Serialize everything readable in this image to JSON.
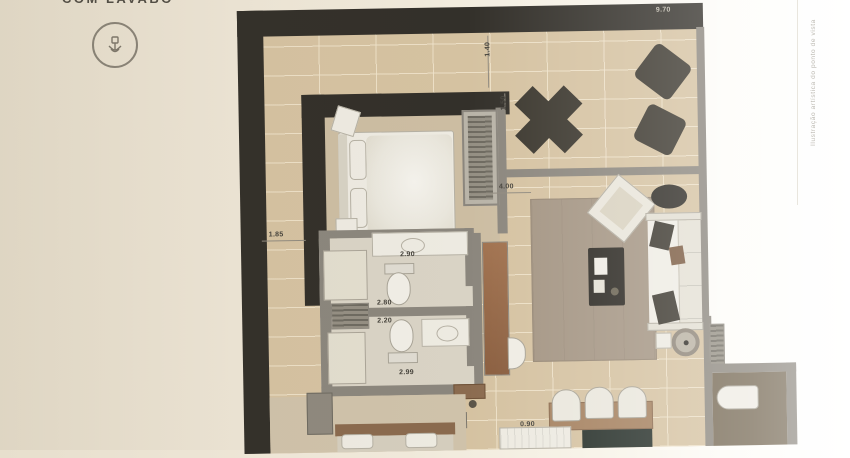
{
  "header": {
    "title_fragment": "COM LAVABO"
  },
  "branding": {
    "logo_icon": "flower-seal-icon"
  },
  "note_vertical": "Ilustração artística do ponto de vista",
  "plan": {
    "dimensions": [
      {
        "id": "total-width",
        "text": "9.70"
      },
      {
        "id": "dim-1-40",
        "text": "1.40"
      },
      {
        "id": "dim-1-50",
        "text": "1.50"
      },
      {
        "id": "dim-4-00",
        "text": "4.00"
      },
      {
        "id": "dim-1-85",
        "text": "1.85"
      },
      {
        "id": "dim-2-90",
        "text": "2.90"
      },
      {
        "id": "dim-2-80",
        "text": "2.80"
      },
      {
        "id": "dim-2-20",
        "text": "2.20"
      },
      {
        "id": "dim-2-99",
        "text": "2.99"
      },
      {
        "id": "dim-0-90",
        "text": "0.90"
      }
    ],
    "colors": {
      "wall_dark": "#33302a",
      "wall_gray": "#8b867d",
      "terrace_tile": "#d5c2a1",
      "wood": "#96684a",
      "rug": "#a49583",
      "fabric_white": "#edeae1",
      "background_cream": "#ece4d4"
    }
  }
}
